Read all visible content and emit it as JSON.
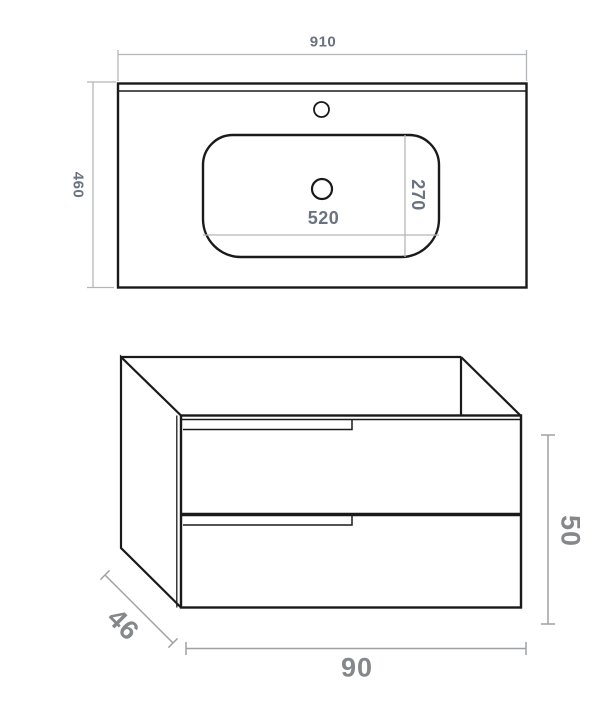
{
  "top_view": {
    "overall_width": "910",
    "overall_depth": "460",
    "basin_width": "520",
    "basin_depth": "270"
  },
  "cabinet_view": {
    "width": "90",
    "depth": "46",
    "height": "50"
  },
  "colors": {
    "outline": "#1a1a1a",
    "dimension_line_light": "#b3b6b8",
    "dimension_line_dark": "#9ea1a4",
    "label_small": "#6b7280",
    "label_large": "#85888b",
    "background": "#ffffff"
  }
}
